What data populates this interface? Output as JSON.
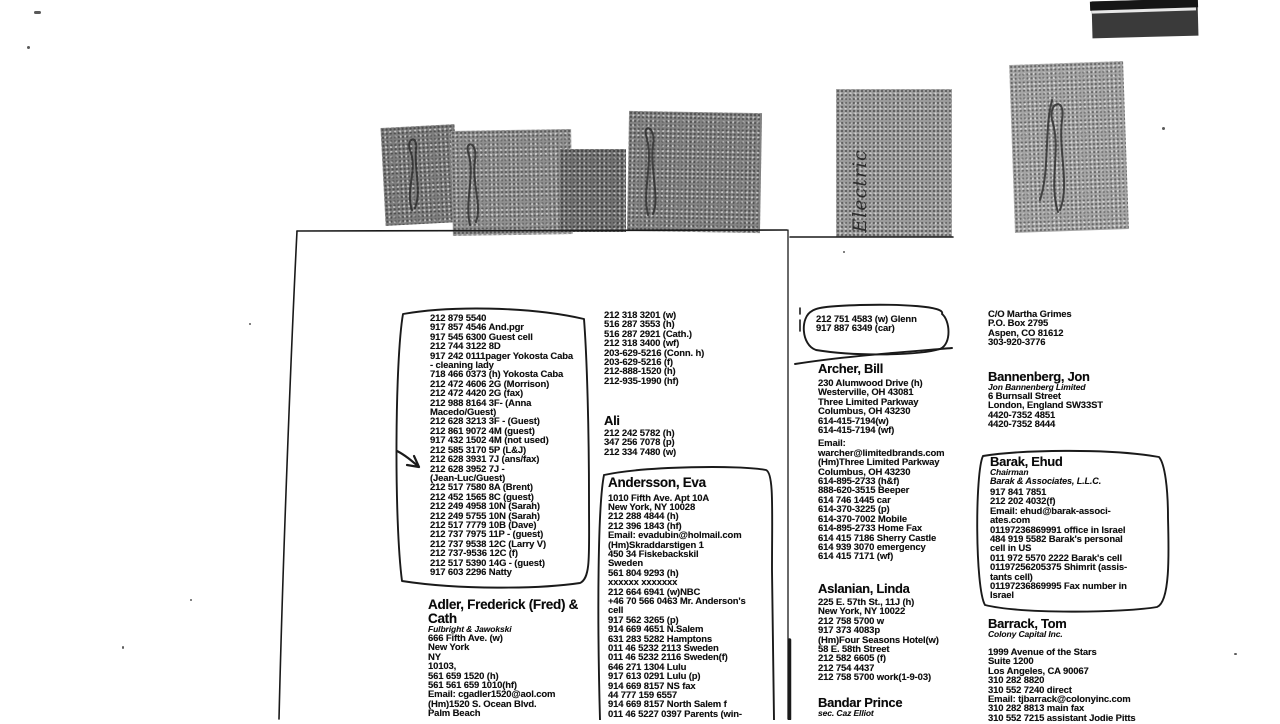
{
  "scan": {
    "tabs": {
      "electric_label": "Electric"
    },
    "left_page": {
      "boxed_list": {
        "lines": [
          "212 879 5540",
          "917 857 4546 And.pgr",
          "917 545 6300 Guest cell",
          "212 744 3122 8D",
          "917 242 0111pager Yokosta Caba",
          "- cleaning lady",
          "718 466 0373 (h) Yokosta Caba",
          "212 472 4606 2G (Morrison)",
          "212 472 4420 2G (fax)",
          "212 988 8164 3F- (Anna",
          "Macedo/Guest)",
          "212 628 3213 3F - (Guest)",
          "212 861 9072 4M (guest)",
          "917 432 1502 4M (not used)",
          "212 585 3170 5P (L&J)",
          "212 628  3931 7J  (ans/fax)",
          "212 628 3952 7J -",
          "(Jean-Luc/Guest)",
          "212 517 7580 8A (Brent)",
          "212 452 1565 8C (guest)",
          "212 249 4958 10N (Sarah)",
          "212 249 5755 10N (Sarah)",
          "212 517 7779 10B (Dave)",
          "212 737 7975 11P - (guest)",
          "212 737 9538 12C (Larry V)",
          "212 737-9536 12C (f)",
          "212 517 5390 14G - (guest)",
          "917 603 2296 Natty"
        ]
      },
      "adler": {
        "name_line1": "Adler, Frederick (Fred) &",
        "name_line2": "Cath",
        "firm": "Fulbright & Jawokski",
        "lines": [
          "666 Fifth Ave. (w)",
          "New York",
          "NY",
          "10103,",
          "561 659 1520 (h)",
          "561 561 659 1010(hf)",
          "Email: cgadler1520@aol.com",
          "(Hm)1520 S. Ocean Blvd.",
          "Palm Beach"
        ]
      },
      "top_numbers": {
        "lines": [
          "212 318 3201 (w)",
          "516 287 3553 (h)",
          " 516 287 2921 (Cath.)",
          "212 318 3400 (wf)",
          "203-629-5216 (Conn. h)",
          "203-629-5216 (f)",
          "212-888-1520 (h)",
          "212-935-1990 (hf)"
        ]
      },
      "ali": {
        "name": "Ali",
        "lines": [
          "212 242 5782 (h)",
          "347 256 7078 (p)",
          "212 334 7480 (w)"
        ]
      },
      "andersson": {
        "name": "Andersson, Eva",
        "lines": [
          "1010 Fifth Ave. Apt 10A",
          "New York, NY 10028",
          "212 288 4844 (h)",
          "212 396 1843 (hf)",
          "Email: evadubin@holmail.com",
          "(Hm)Skraddarstigen 1",
          "450 34 Fiskebackskil",
          "Sweden",
          "561 804 9293 (h)",
          "xxxxxx xxxxxxx",
          "212 664 6941 (w)NBC",
          "+46 70 566 0463 Mr. Anderson's",
          "cell",
          "917 562 3265 (p)",
          "914 669 4651 N.Salem",
          "631 283 5282 Hamptons",
          "011 46 5232 2113 Sweden",
          "011 46 5232 2116 Sweden(f)",
          "646 271 1304 Lulu",
          "917 613 0291 Lulu (p)",
          "914 669 8157 NS fax",
          "44  777 159 6557",
          "914 669 8157 North Salem f",
          "011 46 5227 0397 Parents (win-"
        ]
      }
    },
    "right_page": {
      "glenn": {
        "lines": [
          "212 751 4583 (w) Glenn",
          "917 887 6349 (car)"
        ]
      },
      "archer": {
        "name": "Archer, Bill",
        "lines_a": [
          "230 Alumwood Drive (h)",
          "Westerville, OH 43081",
          "Three Limited Parkway",
          "Columbus, OH 43230",
          "614-415-7194(w)",
          "614-415-7194 (wf)"
        ],
        "lines_b": [
          "Email:",
          "warcher@limitedbrands.com",
          "(Hm)Three Limited Parkway",
          "Columbus, OH 43230",
          "614-895-2733 (h&f)",
          "888-620-3515 Beeper",
          "614 746 1445 car",
          "614-370-3225 (p)",
          "614-370-7002 Mobile",
          "614-895-2733 Home Fax",
          "614 415 7186 Sherry Castle",
          "614 939 3070 emergency",
          "614 415 7171 (wf)"
        ]
      },
      "aslanian": {
        "name": "Aslanian, Linda",
        "lines": [
          "225 E. 57th St., 11J (h)",
          "New York, NY 10022",
          "212 758 5700 w",
          "917 373 4083p",
          "(Hm)Four Seasons Hotel(w)",
          "58 E. 58th Street",
          "212 582 6605 (f)",
          "212 754 4437",
          "212 758 5700 work(1-9-03)"
        ]
      },
      "bandar": {
        "name": "Bandar Prince",
        "subtitle": "sec. Caz Elliot"
      },
      "martha": {
        "lines": [
          "C/O Martha Grimes",
          "P.O. Box 2795",
          "Aspen, CO 81612",
          "303-920-3776"
        ]
      },
      "bannenberg": {
        "name": "Bannenberg, Jon",
        "firm": "Jon Bannenberg Limited",
        "lines": [
          "6 Burnsall Street",
          "London, England SW33ST",
          "4420-7352 4851",
          "4420-7352 8444"
        ]
      },
      "barak": {
        "name": "Barak, Ehud",
        "title": "Chairman",
        "firm": "Barak & Associates, L.L.C.",
        "lines": [
          "917 841 7851",
          "212 202 4032(f)",
          "Email: ehud@barak-associ-",
          "ates.com",
          "01197236869991 office in Israel",
          "484 919 5582 Barak's personal",
          "cell in US",
          "011 972 5570 2222 Barak's cell",
          "01197256205375 Shimrit (assis-",
          "tants cell)",
          "01197236869995 Fax number in",
          "Israel"
        ]
      },
      "barrack": {
        "name": "Barrack, Tom",
        "firm": "Colony Capital Inc.",
        "lines": [
          "1999 Avenue of the Stars",
          "Suite 1200",
          "Los Angeles, CA 90067",
          "310 282 8820",
          "310 552 7240 direct",
          "Email: tjbarrack@colonyinc.com",
          "310 282 8813 main fax",
          "310 552 7215 assistant Jodie Pitts"
        ]
      }
    }
  }
}
